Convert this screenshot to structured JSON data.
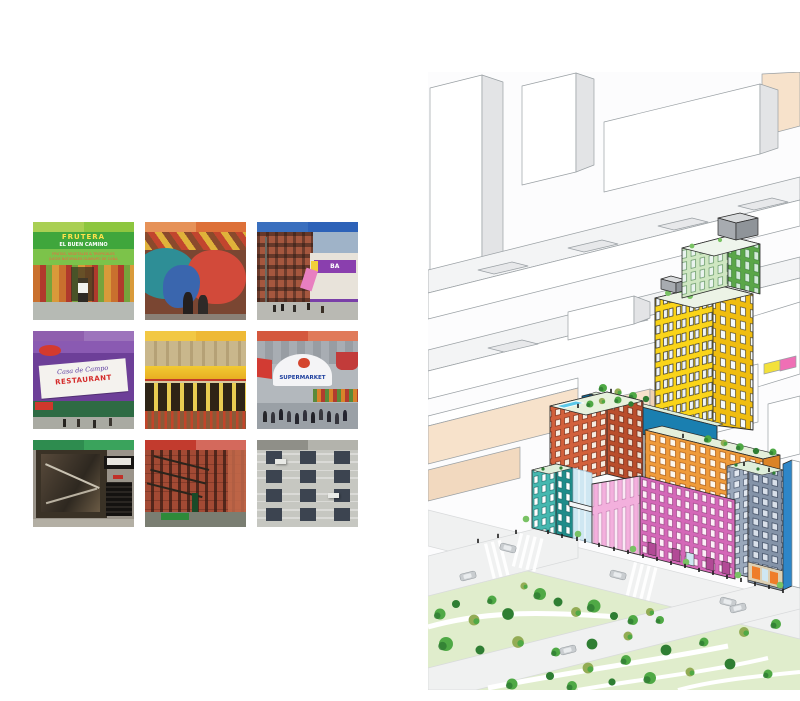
{
  "palette": {
    "outline": "#9aa0a4",
    "bg-side": "#e3e4e6",
    "cream-face": "#f7e2cb",
    "cream-side": "#efd2b4",
    "yellow-left": "#fad419",
    "yellow-right": "#f0bd10",
    "green-top-left": "#cfe7c2",
    "green-top-right": "#5aa648",
    "blue-band": "#1a7fb0",
    "blue-band-dark": "#0f6591",
    "red-left": "#d2613c",
    "red-right": "#b94e2c",
    "orange-face": "#ef9b3a",
    "orange-side": "#db8327",
    "pink-left": "#f3b0dd",
    "pink-front": "#d468b8",
    "teal-left": "#45b8b0",
    "teal-right": "#1f8c8a",
    "slate-face": "#8493a8",
    "slate-left": "#9aa8bb",
    "buff": "#ddd0b4",
    "accent-orange": "#ef7d2a",
    "glass": "#cfe7f2",
    "street": "#f0f1f1",
    "park": "#e0edcc",
    "tree-mid": "#4fa945",
    "tree-dark": "#2f7e33",
    "tree-olive": "#93ac55",
    "tree-light": "#79c264",
    "car": "#c9cdd0",
    "people": "#1c1c1c",
    "pool": "#5bc8e8"
  },
  "photo_collage": {
    "description": "3 x 3 grid of neighborhood street photographs, each with a two-tone color bar header",
    "tiles": [
      {
        "name": "frutera-storefront",
        "bar": [
          "#a9cf53",
          "#8dc63f"
        ],
        "sign_line1": "FRUTERA",
        "sign_line2": "EL BUEN CAMINO",
        "sign_line3": "FRUTAS, VEGETALES & TROPICALES",
        "sign_line4": "JUGOS NATURALES GUARAPO DE CAÑA",
        "scene": "green-awning fruit market with produce stand"
      },
      {
        "name": "street-mural",
        "bar": [
          "#e69258",
          "#dd7038"
        ],
        "scene": "colorful mural wall with pedestrians"
      },
      {
        "name": "bakery-street-corner",
        "bar": [
          "#3a6fbe",
          "#2d62b8"
        ],
        "sign_text": "BA",
        "scene": "brick street corner with purple bakery sign"
      },
      {
        "name": "casa-de-campo-restaurant",
        "bar": [
          "#8f5fae",
          "#9d74bc"
        ],
        "sign_line1": "Casa de Campo",
        "sign_line2": "RESTAURANT",
        "scene": "purple wall with white restaurant banner"
      },
      {
        "name": "yellow-awning-restaurant",
        "bar": [
          "#f2c844",
          "#eeb935"
        ],
        "scene": "yellow restaurant facade with red fence"
      },
      {
        "name": "supermarket",
        "bar": [
          "#d4583e",
          "#e07a5a"
        ],
        "sign_line1": "SUPERMARKET",
        "scene": "white rounded awning market with crowd and produce"
      },
      {
        "name": "dark-storefront",
        "bar": [
          "#2e8c4f",
          "#3aa35c"
        ],
        "scene": "closed bronze-glass shopfront with black awning"
      },
      {
        "name": "brick-tenements",
        "bar": [
          "#c23b2e",
          "#d4695c"
        ],
        "scene": "red brick walk-ups with fire escapes over a retail street"
      },
      {
        "name": "gray-brick-facade",
        "bar": [
          "#8f8f88",
          "#b3b3ac"
        ],
        "scene": "gray brick facade with window grid and AC units"
      }
    ]
  },
  "axon": {
    "description": "Axonometric illustration of a colorful mixed-use development among white city blocks next to a tree-filled park",
    "volumes": [
      {
        "name": "green-crown",
        "color_ref": "green-top-right"
      },
      {
        "name": "yellow-tower",
        "color_ref": "yellow-left"
      },
      {
        "name": "blue-amenity-band",
        "color_ref": "blue-band"
      },
      {
        "name": "terracotta-block",
        "color_ref": "red-left"
      },
      {
        "name": "orange-block",
        "color_ref": "orange-face"
      },
      {
        "name": "pink-bar",
        "color_ref": "pink-front"
      },
      {
        "name": "teal-block",
        "color_ref": "teal-left"
      },
      {
        "name": "slate-block",
        "color_ref": "slate-face"
      }
    ],
    "context": [
      "white city blocks",
      "cream buildings",
      "street grid with cars and crosswalks",
      "park with trees and paths",
      "rooftop terraces with trees and a pool"
    ]
  }
}
